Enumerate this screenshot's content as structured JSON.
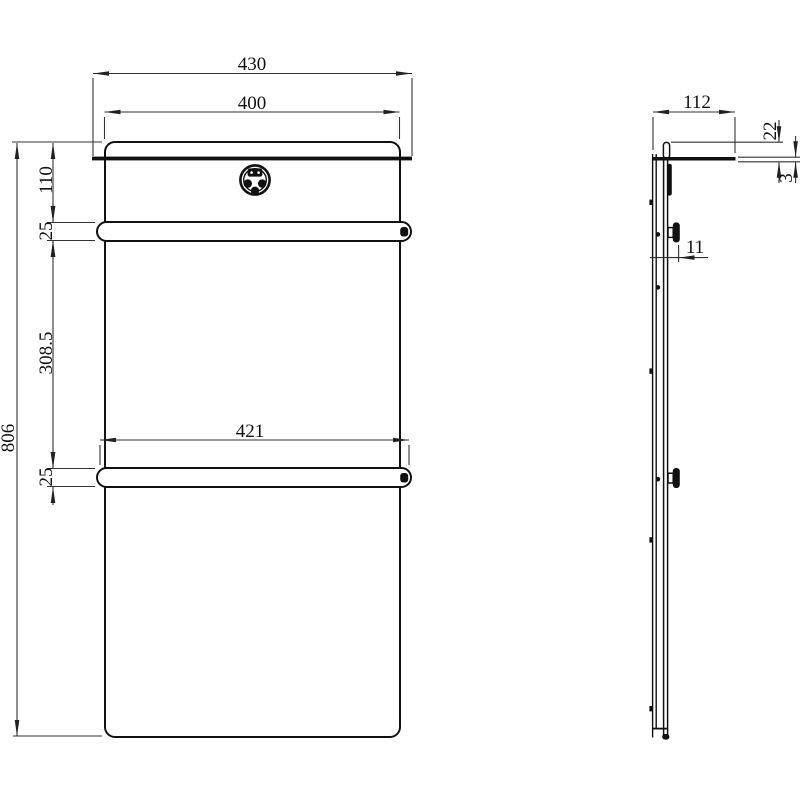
{
  "page": {
    "background": "#ffffff",
    "line_color": "#111111",
    "dim_line_color": "#333333"
  },
  "views": {
    "front": {
      "dims": {
        "overall_width": "430",
        "body_width": "400",
        "top_to_bar": "110",
        "bar_height_upper": "25",
        "bar_spacing": "308.5",
        "bar_length": "421",
        "bar_height_lower": "25",
        "overall_height": "806"
      }
    },
    "side": {
      "dims": {
        "depth": "112",
        "top_lip_height": "22",
        "shelf_thickness": "3",
        "bar_bracket_offset": "11"
      }
    }
  }
}
